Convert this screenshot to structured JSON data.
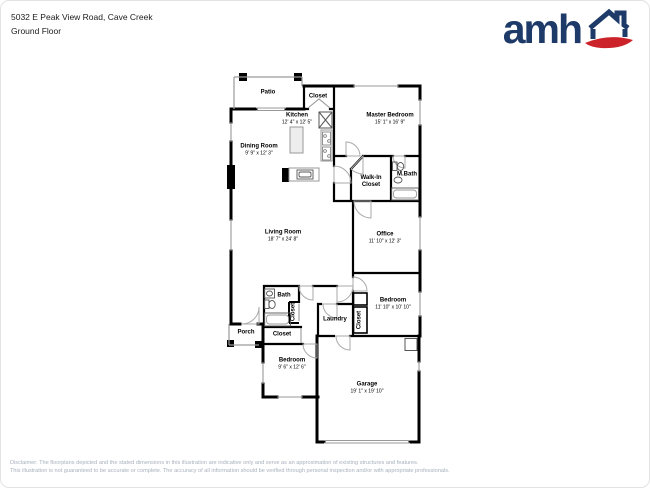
{
  "header": {
    "address": "5032 E Peak View Road, Cave Creek",
    "floor": "Ground Floor"
  },
  "logo": {
    "text": "amh",
    "brand_color": "#1d3a68",
    "accent_color": "#cc2229"
  },
  "rooms": {
    "patio": {
      "name": "Patio"
    },
    "closet_top": {
      "name": "Closet"
    },
    "kitchen": {
      "name": "Kitchen",
      "dims": "12' 4\" x 12' 5\""
    },
    "master_bedroom": {
      "name": "Master Bedroom",
      "dims": "15' 1\" x 16' 9\""
    },
    "dining_room": {
      "name": "Dining Room",
      "dims": "9' 9\" x 12' 3\""
    },
    "walk_in_closet": {
      "name": "Walk-In Closet"
    },
    "m_bath": {
      "name": "M.Bath"
    },
    "living_room": {
      "name": "Living Room",
      "dims": "18' 7\" x 24' 8\""
    },
    "office": {
      "name": "Office",
      "dims": "11' 10\" x 12' 3\""
    },
    "bath": {
      "name": "Bath"
    },
    "closet_bath": {
      "name": "Closet"
    },
    "closet_hall": {
      "name": "Closet"
    },
    "porch": {
      "name": "Porch"
    },
    "laundry": {
      "name": "Laundry"
    },
    "closet_bedroom": {
      "name": "Closet"
    },
    "bedroom_right": {
      "name": "Bedroom",
      "dims": "11' 10\" x 10' 10\""
    },
    "bedroom_left": {
      "name": "Bedroom",
      "dims": "9' 6\" x 12' 6\""
    },
    "garage": {
      "name": "Garage",
      "dims": "19' 1\" x 19' 10\""
    }
  },
  "disclaimer": {
    "line1": "Disclaimer: The floorplans depicted and the stated dimensions in this illustration are indicative only and serve as an approximation of existing structures and features.",
    "line2": "This illustration is not guaranteed to be accurate or complete. The accuracy of all information should be verified through personal inspection and/or with appropriate professionals."
  }
}
